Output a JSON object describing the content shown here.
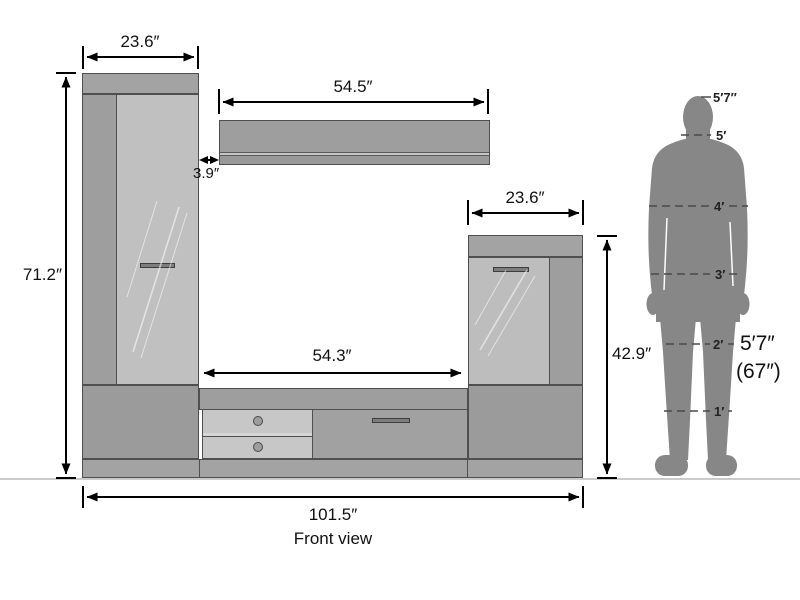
{
  "diagram": {
    "caption": "Front view",
    "type_note": "furniture dimension drawing, entertainment wall unit"
  },
  "dimensions": {
    "left_cabinet_width": "23.6″",
    "total_height": "71.2″",
    "shelf_width": "54.5″",
    "shelf_gap": "3.9″",
    "right_cabinet_width": "23.6″",
    "right_cabinet_height": "42.9″",
    "opening_width": "54.3″",
    "total_width": "101.5″"
  },
  "human_scale": {
    "top_label": "5′7″",
    "markers": [
      "5′",
      "4′",
      "3′",
      "2′",
      "1′"
    ],
    "note_height_ft": "5′7″",
    "note_height_in": "(67″)"
  },
  "colors": {
    "top_band": "#a3a3a3",
    "cabinet_stile": "#9e9e9e",
    "cabinet_door": "#c0c0c0",
    "bottom_panel": "#9b9b9b",
    "drawer_front": "#c7c7c7",
    "flap_front": "#a1a1a1",
    "plinth": "#a3a3a3",
    "silhouette": "#878787",
    "dimension_line": "#000000",
    "ground_line": "#cbcbcb",
    "background": "#ffffff"
  }
}
